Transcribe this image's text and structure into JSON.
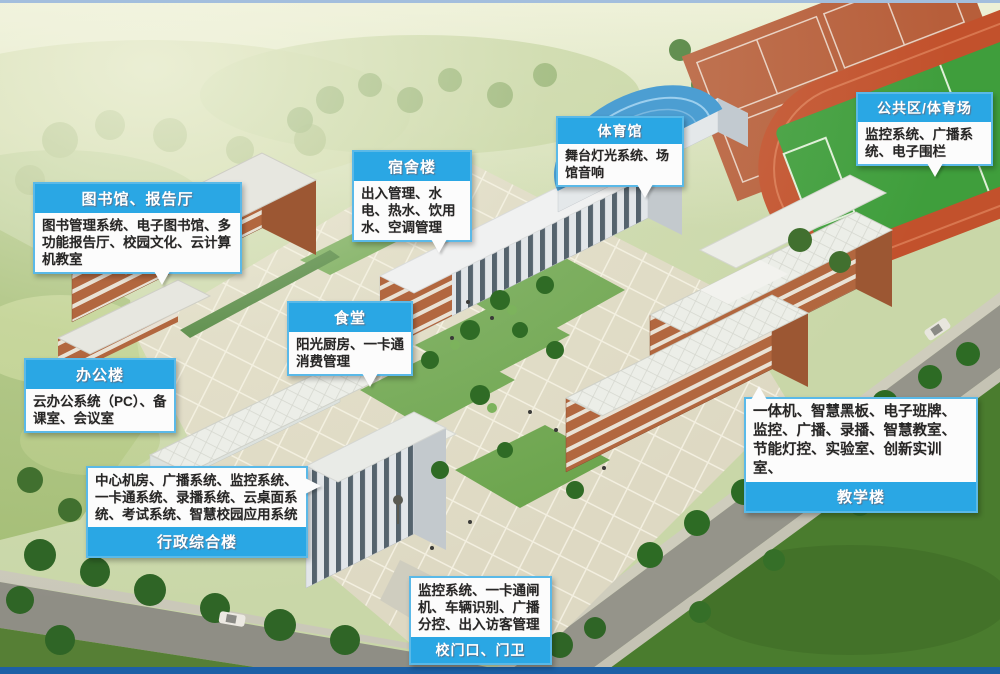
{
  "callouts": [
    {
      "id": "library",
      "title": "图书馆、报告厅",
      "body": "图书管理系统、电子图书馆、多功能报告厅、校园文化、云计算机教室"
    },
    {
      "id": "dormitory",
      "title": "宿舍楼",
      "body": "出入管理、水电、热水、饮用水、空调管理"
    },
    {
      "id": "gymnasium",
      "title": "体育馆",
      "body": "舞台灯光系统、场馆音响"
    },
    {
      "id": "public",
      "title": "公共区/体育场",
      "body": "监控系统、广播系统、电子围栏"
    },
    {
      "id": "canteen",
      "title": "食堂",
      "body": "阳光厨房、一卡通消费管理"
    },
    {
      "id": "office",
      "title": "办公楼",
      "body": "云办公系统（PC）、备课室、会议室"
    },
    {
      "id": "admin",
      "title": "行政综合楼",
      "body": "中心机房、广播系统、监控系统、一卡通系统、录播系统、云桌面系统、考试系统、智慧校园应用系统"
    },
    {
      "id": "teaching",
      "title": "教学楼",
      "body": "一体机、智慧黑板、电子班牌、监控、广播、录播、智慧教室、节能灯控、实验室、创新实训室、"
    },
    {
      "id": "gate",
      "title": "校门口、门卫",
      "body": "监控系统、一卡通闸机、车辆识别、广播分控、出入访客管理"
    }
  ],
  "colors": {
    "callout_header_bg": "#2aa7e4",
    "callout_header_text": "#ffffff",
    "callout_border": "#5ab9e8",
    "callout_body_bg": "#fcfcfc",
    "callout_body_text": "#262626",
    "top_line": "#a3bedd",
    "bottom_bar": "#1d60a6"
  }
}
